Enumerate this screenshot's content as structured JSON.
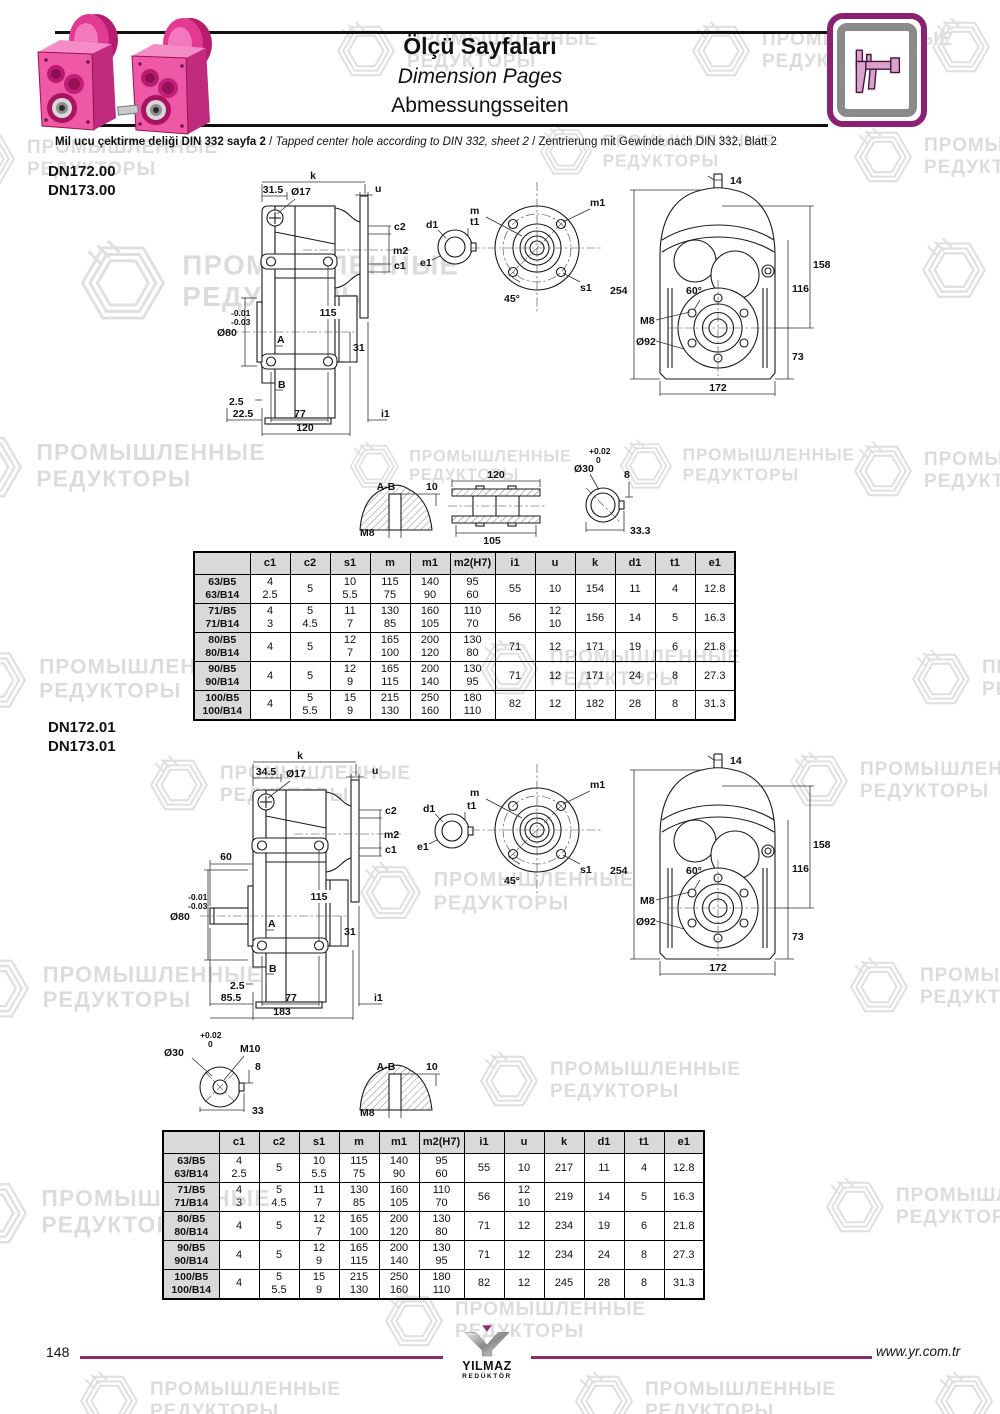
{
  "header": {
    "title_tr": "Ölçü Sayfaları",
    "title_en": "Dimension Pages",
    "title_de": "Abmessungsseiten",
    "subtitle_tr": "Mil ucu çektirme deliği DIN 332 sayfa 2",
    "subtitle_en": "Tapped center hole according to DIN 332, sheet 2",
    "subtitle_de": "Zentrierung mit Gewinde nach DIN 332, Blatt 2",
    "sep": "/"
  },
  "watermark": {
    "line1": "ПРОМЫШЛЕННЫЕ",
    "line2": "РЕДУКТОРЫ"
  },
  "sections": [
    {
      "model_a": "DN172.00",
      "model_b": "DN173.00"
    },
    {
      "model_a": "DN172.01",
      "model_b": "DN173.01"
    }
  ],
  "drawings": {
    "side1": {
      "k": "k",
      "off": "31.5",
      "hole": "Ø17",
      "u": "u",
      "c2": "c2",
      "m2": "m2",
      "c1": "c1",
      "h": "115",
      "tol1": "-0.01",
      "tol2": "-0.03",
      "bore": "Ø80",
      "a": "A",
      "b": "B",
      "d31": "31",
      "d25": "2.5",
      "dleft": "22.5",
      "d77": "77",
      "i1": "i1",
      "total": "120"
    },
    "side2": {
      "k": "k",
      "off": "34.5",
      "hole": "Ø17",
      "u": "u",
      "c2": "c2",
      "m2": "m2",
      "c1": "c1",
      "d60": "60",
      "h": "115",
      "tol1": "-0.01",
      "tol2": "-0.03",
      "bore": "Ø80",
      "a": "A",
      "b": "B",
      "d31": "31",
      "d25": "2.5",
      "dleft": "85.5",
      "d77": "77",
      "i1": "i1",
      "total": "183"
    },
    "shaft_end": {
      "d1": "d1",
      "t1": "t1",
      "e1": "e1"
    },
    "flange": {
      "m": "m",
      "m1": "m1",
      "s1": "s1",
      "ang": "45°"
    },
    "front": {
      "d14": "14",
      "d254": "254",
      "d158": "158",
      "d116": "116",
      "d73": "73",
      "ang": "60°",
      "m8": "M8",
      "d92": "Ø92",
      "d172": "172"
    },
    "det_key": {
      "ab": "A-B",
      "d10": "10",
      "m8": "M8"
    },
    "det_shaft": {
      "top": "120",
      "bot": "105"
    },
    "det_c1": {
      "t1": "+0.02",
      "t2": "0",
      "d30": "Ø30",
      "d8": "8",
      "w": "33.3"
    },
    "det_c2": {
      "t1": "+0.02",
      "t2": "0",
      "d30": "Ø30",
      "m10": "M10",
      "d8": "8",
      "w": "33"
    }
  },
  "table": {
    "headers": [
      "",
      "c1",
      "c2",
      "s1",
      "m",
      "m1",
      "m2(H7)",
      "i1",
      "u",
      "k",
      "d1",
      "t1",
      "e1"
    ]
  },
  "tables": [
    {
      "rows": [
        [
          "63/B5\n63/B14",
          "4\n2.5",
          "5",
          "10\n5.5",
          "115\n75",
          "140\n90",
          "95\n60",
          "55",
          "10",
          "154",
          "11",
          "4",
          "12.8"
        ],
        [
          "71/B5\n71/B14",
          "4\n3",
          "5\n4.5",
          "11\n7",
          "130\n85",
          "160\n105",
          "110\n70",
          "56",
          "12\n10",
          "156",
          "14",
          "5",
          "16.3"
        ],
        [
          "80/B5\n80/B14",
          "4",
          "5",
          "12\n7",
          "165\n100",
          "200\n120",
          "130\n80",
          "71",
          "12",
          "171",
          "19",
          "6",
          "21.8"
        ],
        [
          "90/B5\n90/B14",
          "4",
          "5",
          "12\n9",
          "165\n115",
          "200\n140",
          "130\n95",
          "71",
          "12",
          "171",
          "24",
          "8",
          "27.3"
        ],
        [
          "100/B5\n100/B14",
          "4",
          "5\n5.5",
          "15\n9",
          "215\n130",
          "250\n160",
          "180\n110",
          "82",
          "12",
          "182",
          "28",
          "8",
          "31.3"
        ]
      ]
    },
    {
      "rows": [
        [
          "63/B5\n63/B14",
          "4\n2.5",
          "5",
          "10\n5.5",
          "115\n75",
          "140\n90",
          "95\n60",
          "55",
          "10",
          "217",
          "11",
          "4",
          "12.8"
        ],
        [
          "71/B5\n71/B14",
          "4\n3",
          "5\n4.5",
          "11\n7",
          "130\n85",
          "160\n105",
          "110\n70",
          "56",
          "12\n10",
          "219",
          "14",
          "5",
          "16.3"
        ],
        [
          "80/B5\n80/B14",
          "4",
          "5",
          "12\n7",
          "165\n100",
          "200\n120",
          "130\n80",
          "71",
          "12",
          "234",
          "19",
          "6",
          "21.8"
        ],
        [
          "90/B5\n90/B14",
          "4",
          "5",
          "12\n9",
          "165\n115",
          "200\n140",
          "130\n95",
          "71",
          "12",
          "234",
          "24",
          "8",
          "27.3"
        ],
        [
          "100/B5\n100/B14",
          "4",
          "5\n5.5",
          "15\n9",
          "215\n130",
          "250\n160",
          "180\n110",
          "82",
          "12",
          "245",
          "28",
          "8",
          "31.3"
        ]
      ]
    }
  ],
  "footer": {
    "page": "148",
    "url": "www.yr.com.tr",
    "logo_line1": "YILMAZ",
    "logo_line2": "REDÜKTÖR"
  }
}
